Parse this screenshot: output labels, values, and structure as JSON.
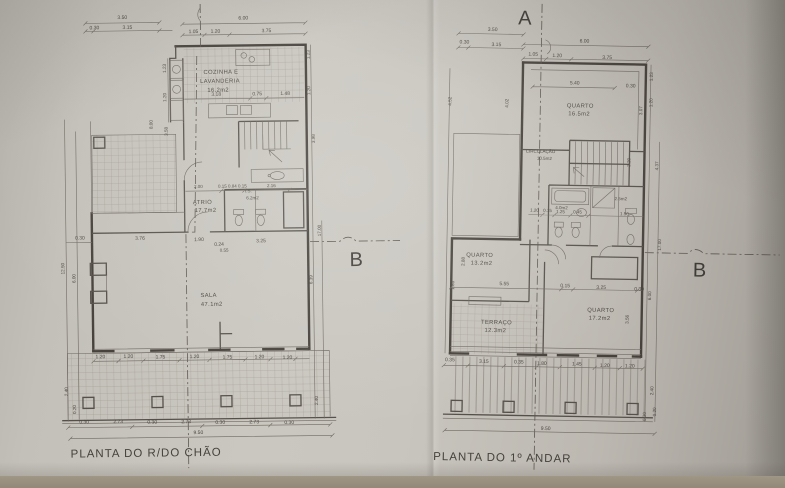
{
  "markers": {
    "a": "A",
    "b": "B"
  },
  "left": {
    "title": "PLANTA DO R/DO CHÃO",
    "rooms": {
      "kitchen": {
        "l1": "COZINHA E",
        "l2": "LAVANDERIA",
        "area": "16.2m2"
      },
      "atrio": {
        "name": "ATRIO",
        "area": "17.7m2"
      },
      "is": {
        "name": "I.S.",
        "area": "6.2m2"
      },
      "sala": {
        "name": "SALA",
        "area": "47.1m2"
      }
    },
    "d": {
      "top": [
        "3.50",
        "0.30",
        "3.15",
        "6.00",
        "1.05",
        "1.20",
        "3.75"
      ],
      "k": [
        "3.18",
        "0.75",
        "1.48"
      ],
      "a": [
        "2.00",
        "0.15 0.84 0.15",
        "2.16"
      ],
      "m": [
        "0.30",
        "3.76",
        "1.90",
        "0.24",
        "3.25",
        "0.55"
      ],
      "b": [
        "1.20",
        "1.20",
        "1.75",
        "1.20",
        "1.75",
        "1.20",
        "1.20"
      ],
      "tz": [
        "0.30",
        "2.73",
        "0.30",
        "2.73",
        "0.30",
        "2.73",
        "0.30"
      ],
      "total": "9.50",
      "v": [
        "12.50",
        "6.00",
        "8.00",
        "3.58",
        "2.40",
        "0.20",
        "1.23",
        "1.20",
        "1.23",
        "1.20",
        "3.98",
        "17.00",
        "6.39",
        "2.40"
      ]
    }
  },
  "right": {
    "title": "PLANTA DO 1º ANDAR",
    "rooms": {
      "q1": {
        "name": "QUARTO",
        "area": "16.5m2"
      },
      "circ": {
        "name": "CIRCULAÇÃO",
        "area": "10.5m2"
      },
      "is1": {
        "area": "4.0m2"
      },
      "is2": {
        "area": "2.5m2"
      },
      "q2": {
        "name": "QUARTO",
        "area": "13.2m2"
      },
      "terr": {
        "name": "TERRAÇO",
        "area": "12.3m2"
      },
      "q3": {
        "name": "QUARTO",
        "area": "17.2m2"
      }
    },
    "d": {
      "top": [
        "3.50",
        "0.30",
        "3.15",
        "6.00",
        "1.05",
        "1.20",
        "3.75"
      ],
      "i540": "5.40",
      "bath": [
        "1.20",
        "0.15",
        "1.25",
        "0.45",
        "1.50"
      ],
      "m": [
        "5.55",
        "0.15",
        "3.25",
        "0.30"
      ],
      "b": [
        "0.35",
        "3.15",
        "0.35",
        "1.80",
        "1.45",
        "1.20",
        "1.20"
      ],
      "total": "9.50",
      "o": [
        "0.30",
        "0.30",
        "0.20"
      ],
      "v": [
        "4.52",
        "4.02",
        "2.88",
        "1.30",
        "1.23",
        "1.20",
        "3.07",
        "2.20",
        "4.37",
        "3.56",
        "6.00",
        "17.00",
        "2.40"
      ]
    }
  }
}
